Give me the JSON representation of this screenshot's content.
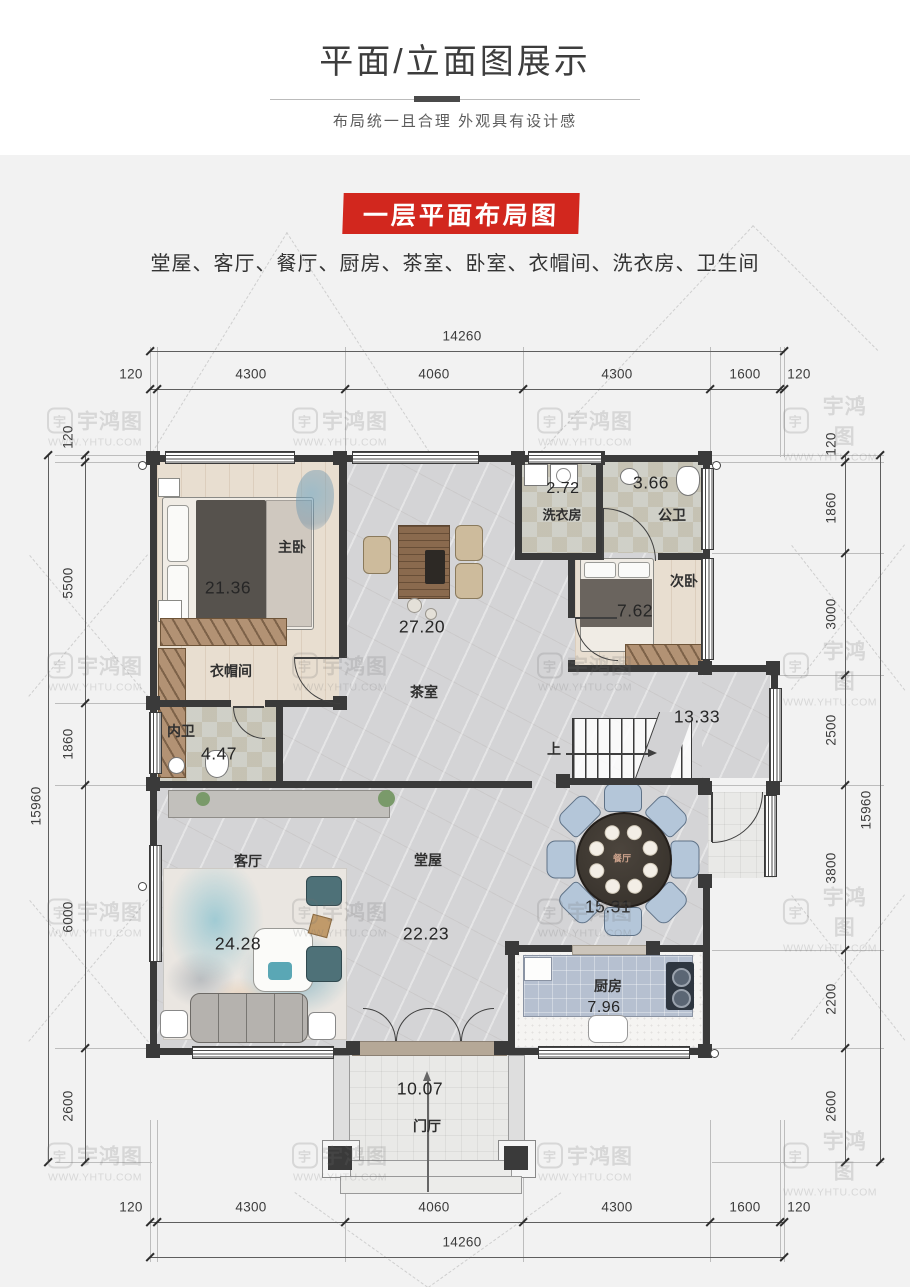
{
  "header": {
    "title": "平面/立面图展示",
    "subtitle": "布局统一且合理 外观具有设计感"
  },
  "banner": {
    "label": "一层平面布局图",
    "bg": "#d2271e"
  },
  "room_list": "堂屋、客厅、餐厅、厨房、茶室、卧室、衣帽间、洗衣房、卫生间",
  "watermark": {
    "logo_char": "宇",
    "brand": "宇鸿图",
    "url": "WWW.YHTU.COM"
  },
  "plan": {
    "rooms": {
      "master_bedroom": {
        "name": "主卧",
        "area": "21.36"
      },
      "cloakroom": {
        "name": "衣帽间"
      },
      "ensuite_bath": {
        "name": "内卫",
        "area": "4.47"
      },
      "tea_room": {
        "name": "茶室",
        "area": "27.20"
      },
      "laundry": {
        "name": "洗衣房",
        "area": "2.72"
      },
      "public_bath": {
        "name": "公卫",
        "area": "3.66"
      },
      "second_bedroom": {
        "name": "次卧",
        "area": "7.62"
      },
      "stair_hall": {
        "area": "13.33"
      },
      "living_room": {
        "name": "客厅",
        "area": "24.28"
      },
      "main_hall": {
        "name": "堂屋",
        "area": "22.23"
      },
      "dining": {
        "name": "餐厅",
        "area": "15.31"
      },
      "kitchen": {
        "name": "厨房",
        "area": "7.96"
      },
      "foyer": {
        "name": "门厅",
        "area": "10.07"
      }
    },
    "stairs_up_label": "上",
    "dimensions": {
      "top": {
        "total": "14260",
        "segments": [
          "120",
          "4300",
          "4060",
          "4300",
          "1600",
          "120"
        ]
      },
      "bottom": {
        "total": "14260",
        "segments": [
          "120",
          "4300",
          "4060",
          "4300",
          "1600",
          "120"
        ]
      },
      "left": {
        "total": "15960",
        "segments": [
          "120",
          "5500",
          "1860",
          "6000",
          "2600"
        ]
      },
      "right": {
        "total": "15960",
        "segments": [
          "120",
          "1860",
          "3000",
          "2500",
          "3800",
          "2200",
          "2600"
        ]
      }
    }
  },
  "colors": {
    "accent_red": "#d2271e",
    "wall": "#3a3a3a",
    "dim_text": "#3c3c3c"
  }
}
